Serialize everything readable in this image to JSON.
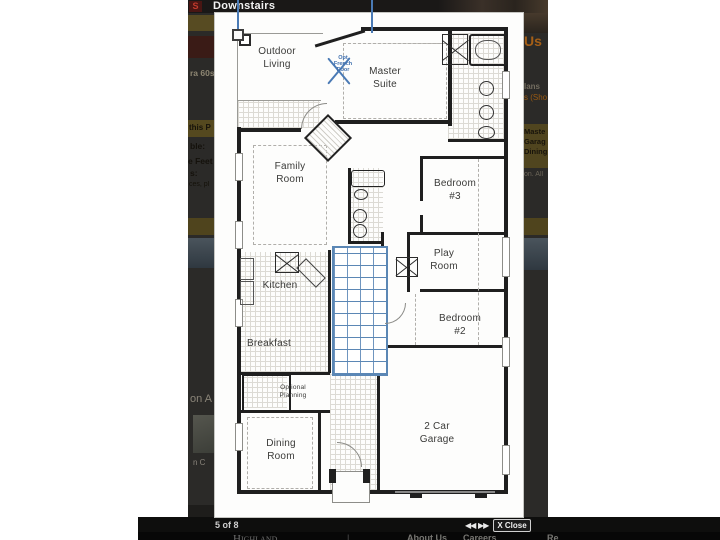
{
  "lightbox": {
    "title": "Downstairs",
    "pagination": "5 of 8",
    "prev_label": "◀◀",
    "next_label": "▶▶",
    "close_label": "X Close"
  },
  "plan": {
    "rooms": [
      {
        "id": "outdoor-living",
        "label": "Outdoor\nLiving"
      },
      {
        "id": "master-suite",
        "label": "Master\nSuite"
      },
      {
        "id": "family-room",
        "label": "Family\nRoom"
      },
      {
        "id": "bedroom-3",
        "label": "Bedroom\n#3"
      },
      {
        "id": "play-room",
        "label": "Play\nRoom"
      },
      {
        "id": "kitchen",
        "label": "Kitchen"
      },
      {
        "id": "bedroom-2",
        "label": "Bedroom\n#2"
      },
      {
        "id": "breakfast",
        "label": "Breakfast"
      },
      {
        "id": "optional-planning",
        "label": "Optional\nPlanning"
      },
      {
        "id": "dining-room",
        "label": "Dining\nRoom"
      },
      {
        "id": "garage",
        "label": "2 Car\nGarage"
      }
    ],
    "annotation": {
      "text": "Opt\nFrench\nDoor"
    }
  },
  "background": {
    "left_fragments": [
      {
        "text": "S"
      },
      {
        "text": "ra 60s"
      },
      {
        "text": "this P"
      },
      {
        "text": "ble:"
      },
      {
        "text": "e Feet"
      },
      {
        "text": "s:"
      },
      {
        "text": "ces, pl"
      },
      {
        "text": "on A"
      },
      {
        "text": "n C"
      }
    ],
    "right_fragments": [
      {
        "text": "Us"
      },
      {
        "text": "lans"
      },
      {
        "text": "s (Sho"
      },
      {
        "text": "Maste"
      },
      {
        "text": "Garag"
      },
      {
        "text": "Dining"
      },
      {
        "text": "on. All"
      }
    ],
    "footer": {
      "brand": "Highland",
      "separator": "|",
      "links": [
        {
          "label": "About Us"
        },
        {
          "label": "Careers"
        },
        {
          "label": "Re"
        }
      ]
    }
  },
  "colors": {
    "stairs_blue": "#5b87b5",
    "annotation_blue": "#4a7ab5",
    "accent_orange": "#a55f17",
    "olive_band": "#50451f",
    "maroon_band": "#3a1b16",
    "red_letter": "#c23b2d",
    "overlay_dark": "#2b2a28"
  }
}
